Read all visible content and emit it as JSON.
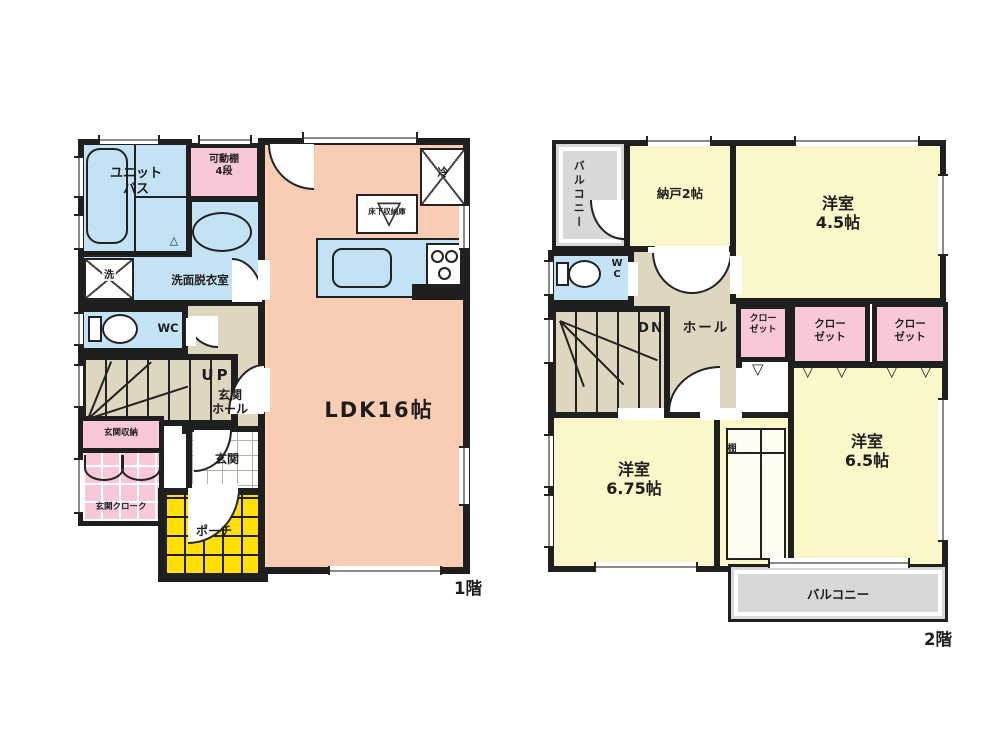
{
  "colors": {
    "wall": "#1f1f1f",
    "ldk": "#f8cdb4",
    "water_blue": "#c3e3f4",
    "pink": "#f8c8d8",
    "yellow_room": "#faf7c9",
    "beige": "#ded6bf",
    "balcony_gray": "#d8d8d8",
    "porch_yellow": "#ffdf05"
  },
  "floor1": {
    "label": "1階",
    "ldk": "LDK16帖",
    "unit_bath": "ユニット\nバス",
    "movable_shelf": "可動棚\n4段",
    "washroom": "洗面脱衣室",
    "washer": "洗",
    "wc": "WC",
    "up": "UP",
    "entrance_hall": "玄関\nホール",
    "entrance_storage": "玄関収納",
    "entrance_cloak": "玄関クローク",
    "entrance": "玄関",
    "porch": "ポーチ",
    "fridge": "冷",
    "underfloor_storage": "床下収納庫"
  },
  "floor2": {
    "label": "2階",
    "balcony_top": "バルコニー",
    "storage_room": "納戸2帖",
    "room_45": "洋室\n4.5帖",
    "wc": "W\nC",
    "dn": "DN",
    "hall": "ホール",
    "closet1": "クロー\nゼット",
    "closet2": "クロー\nゼット",
    "closet3": "クロー\nゼット",
    "shelf": "棚",
    "room_675": "洋室\n6.75帖",
    "room_65": "洋室\n6.5帖",
    "balcony_bottom": "バルコニー"
  }
}
